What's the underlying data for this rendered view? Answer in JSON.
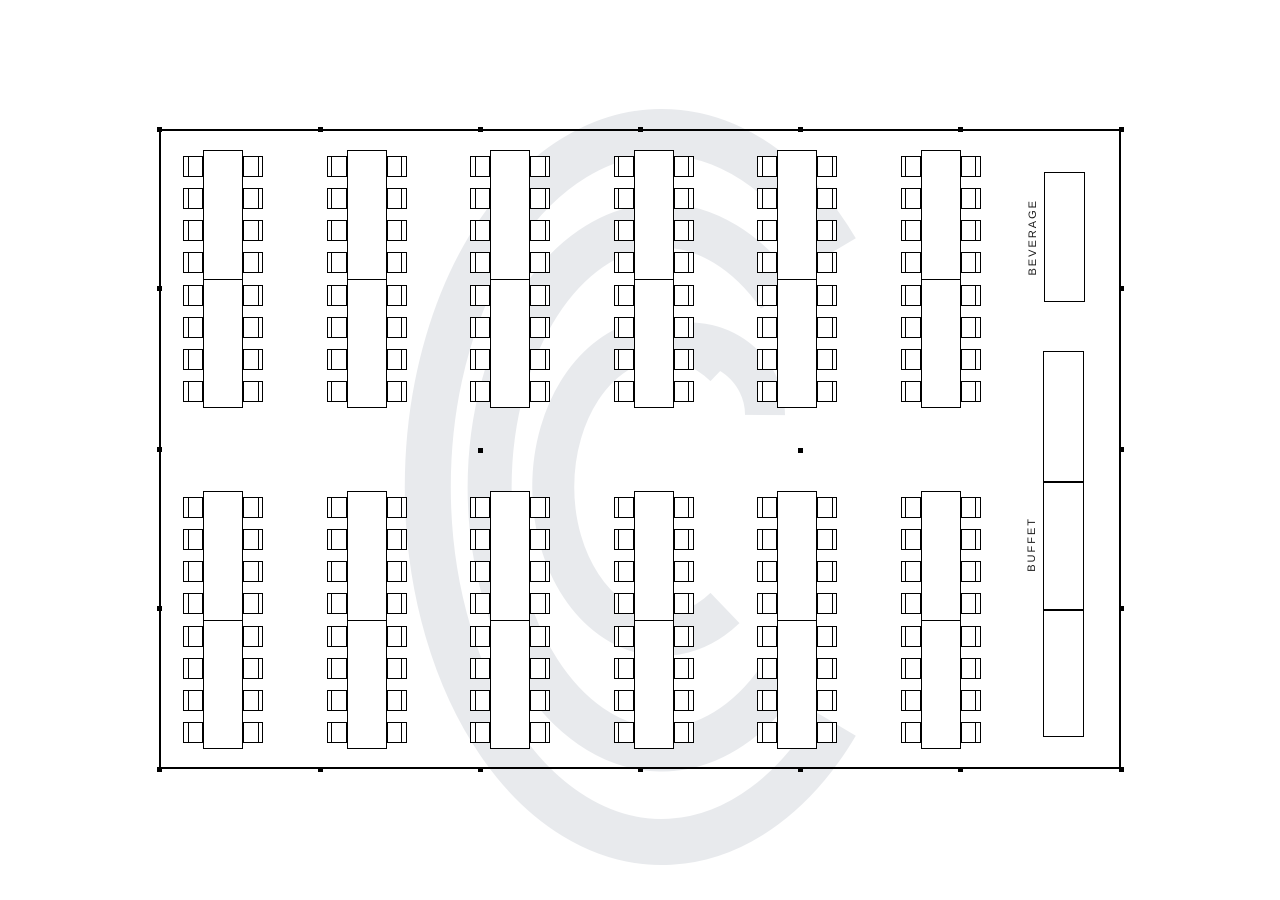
{
  "diagram": {
    "background": "#ffffff",
    "line_color": "#000000",
    "watermark_color": "#e8eaed"
  },
  "room": {
    "x": 159,
    "y": 129,
    "width": 962,
    "height": 640
  },
  "banquet": {
    "column_table_lefts": [
      203,
      346.5,
      490,
      633.5,
      777,
      920.5
    ],
    "row_table_tops": [
      150,
      491
    ],
    "table_width": 40,
    "table_segment_height": 129,
    "segments_per_table": 2,
    "chairs_per_side": 8,
    "chair_width": 20,
    "chair_height": 21,
    "chair_first_offset": 6,
    "chair_pitch": 32.14,
    "groups": 12,
    "seats_total": 192
  },
  "service_tables": {
    "beverage": {
      "label": "BEVERAGE",
      "x": 1044,
      "y": 172,
      "width": 41,
      "height": 130,
      "segments": 1
    },
    "buffet": {
      "label": "BUFFET",
      "x": 1043,
      "y": 351,
      "width": 41,
      "height": 386,
      "segments": 3
    }
  },
  "poles": {
    "perimeter": [
      [
        159,
        129
      ],
      [
        320,
        129
      ],
      [
        480,
        129
      ],
      [
        640,
        129
      ],
      [
        800,
        129
      ],
      [
        960,
        129
      ],
      [
        1121,
        129
      ],
      [
        159,
        769
      ],
      [
        320,
        769
      ],
      [
        480,
        769
      ],
      [
        640,
        769
      ],
      [
        800,
        769
      ],
      [
        960,
        769
      ],
      [
        1121,
        769
      ],
      [
        159,
        288
      ],
      [
        159,
        449
      ],
      [
        159,
        608
      ],
      [
        1121,
        288
      ],
      [
        1121,
        449
      ],
      [
        1121,
        608
      ]
    ],
    "interior": [
      [
        480,
        450
      ],
      [
        800,
        450
      ]
    ]
  }
}
